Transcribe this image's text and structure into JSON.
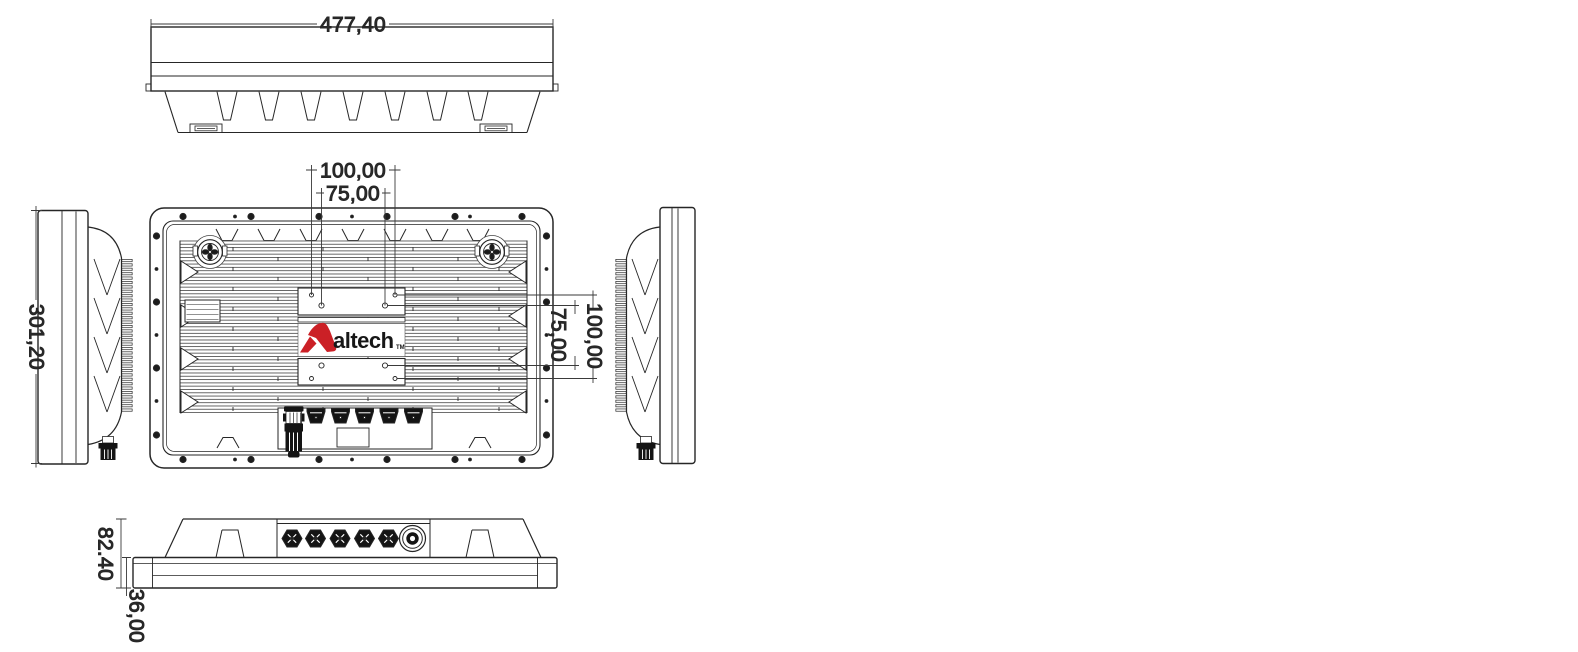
{
  "drawing": {
    "background": "#ffffff",
    "line_color": "#262626",
    "dim_text_color": "#2b2b2b",
    "logo": {
      "text": "altech",
      "trademark": "TM",
      "accent_color": "#cb2026",
      "text_color": "#171717"
    },
    "dimensions": {
      "overall_width": "477,40",
      "overall_height": "301,20",
      "vesa_width_outer": "100,00",
      "vesa_width_inner": "75,00",
      "vesa_height_inner": "75,00",
      "vesa_height_outer": "100,00",
      "total_depth": "82.40",
      "front_depth": "36,00"
    }
  }
}
